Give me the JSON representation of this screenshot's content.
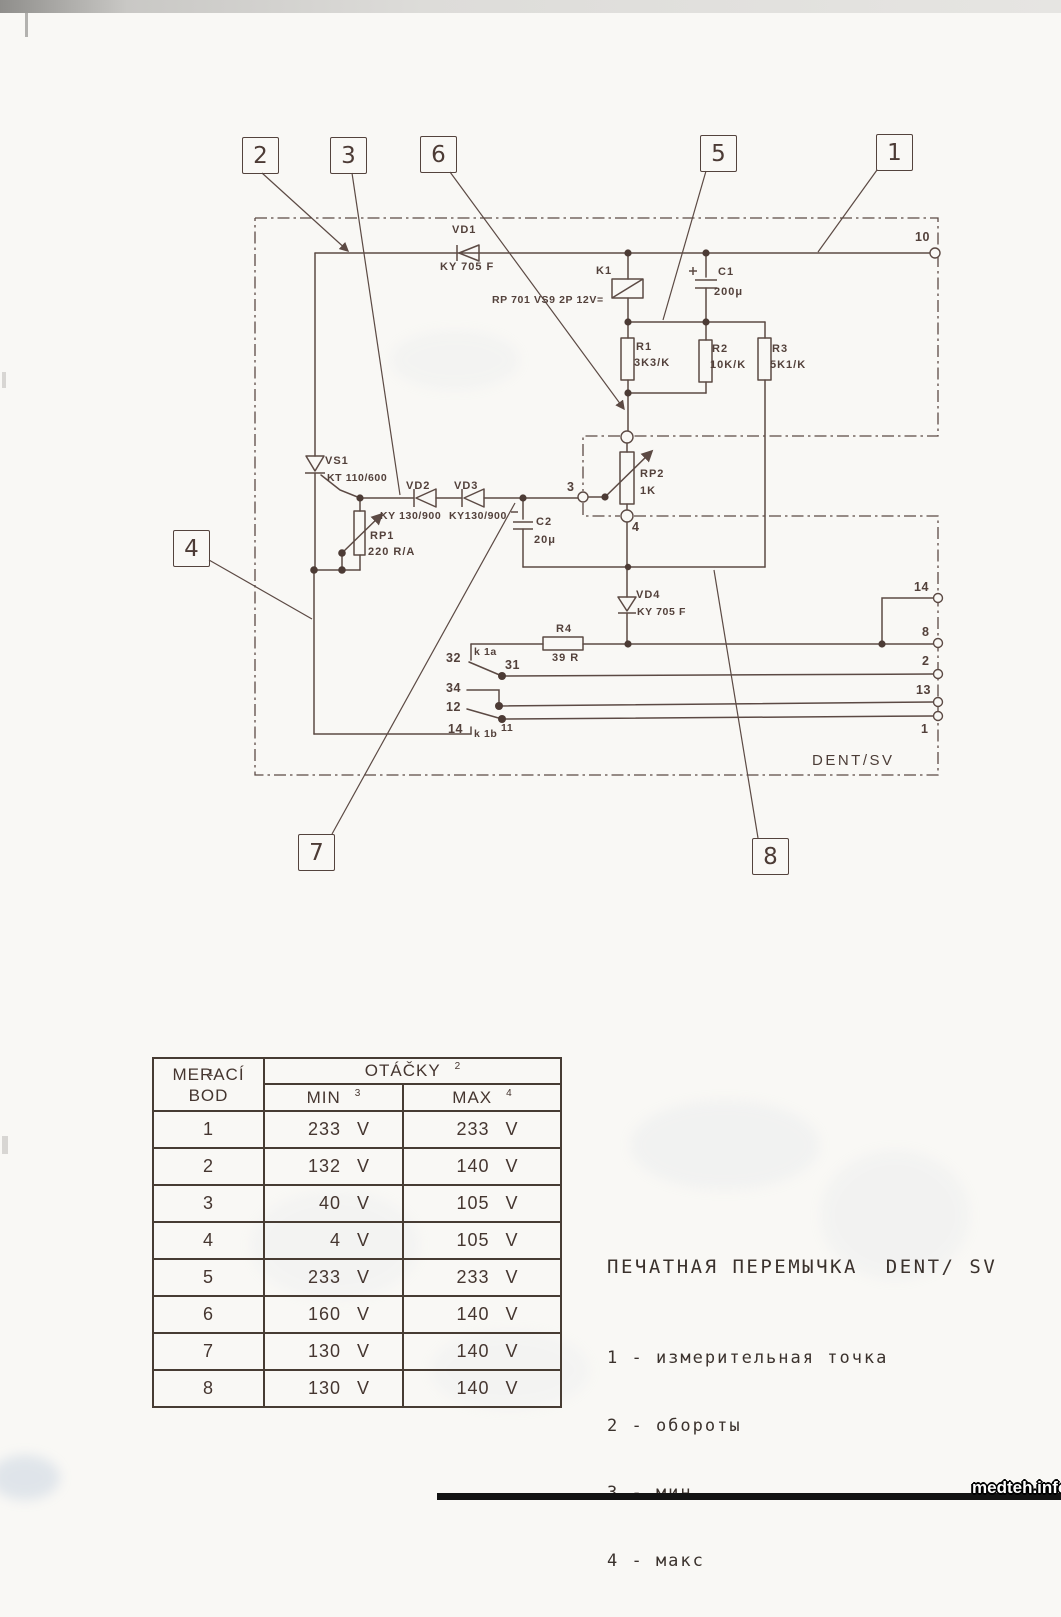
{
  "watermark": "medteh.info",
  "callouts": {
    "n1": "1",
    "n2": "2",
    "n3": "3",
    "n4": "4",
    "n5": "5",
    "n6": "6",
    "n7": "7",
    "n8": "8"
  },
  "schematic": {
    "block_name": "DENT/SV",
    "labels": {
      "vd1": "VD1",
      "vd1_type": "KY 705 F",
      "k1": "K1",
      "k1_type": "RP 701 VS9 2P 12V=",
      "c1": "C1",
      "c1_val": "200μ",
      "r1": "R1",
      "r1_val": "3K3/K",
      "r2": "R2",
      "r2_val": "10K/K",
      "r3": "R3",
      "r3_val": "5K1/K",
      "vs1": "VS1",
      "vs1_type": "KT 110/600",
      "vd2": "VD2",
      "vd2_type": "KY 130/900",
      "vd3": "VD3",
      "vd3_type": "KY130/900",
      "rp1": "RP1",
      "rp1_val": "220 R/A",
      "c2": "C2",
      "c2_val": "20μ",
      "rp2": "RP2",
      "rp2_val": "1K",
      "vd4": "VD4",
      "vd4_type": "KY 705 F",
      "r4": "R4",
      "r4_val": "39 R",
      "k_32": "32",
      "k_1a": "k 1a",
      "k_31": "31",
      "k_34": "34",
      "k_12": "12",
      "k_14": "14",
      "k_1b": "k 1b",
      "k_11": "11"
    },
    "terminals": {
      "t10": "10",
      "t3": "3",
      "t4": "4",
      "t14": "14",
      "t8": "8",
      "t2": "2",
      "t13": "13",
      "t1": "1"
    }
  },
  "table": {
    "col1_line1": "MERACÍ",
    "col1_line2": "BOD",
    "col1_sup": "1",
    "otacky": "OTÁČKY",
    "otacky_sup": "2",
    "min": "MIN",
    "min_sup": "3",
    "max": "MAX",
    "max_sup": "4",
    "unit": "V",
    "rows": [
      {
        "bod": "1",
        "min": "233",
        "max": "233"
      },
      {
        "bod": "2",
        "min": "132",
        "max": "140"
      },
      {
        "bod": "3",
        "min": "40",
        "max": "105"
      },
      {
        "bod": "4",
        "min": "4",
        "max": "105"
      },
      {
        "bod": "5",
        "min": "233",
        "max": "233"
      },
      {
        "bod": "6",
        "min": "160",
        "max": "140"
      },
      {
        "bod": "7",
        "min": "130",
        "max": "140"
      },
      {
        "bod": "8",
        "min": "130",
        "max": "140"
      }
    ]
  },
  "legend": {
    "title": "ПЕЧАТНАЯ ПЕРЕМЫЧКА  DENT/ SV",
    "items": [
      "1 - измерительная точка",
      "2 - обороты",
      "3 - мин",
      "4 - макс"
    ]
  }
}
